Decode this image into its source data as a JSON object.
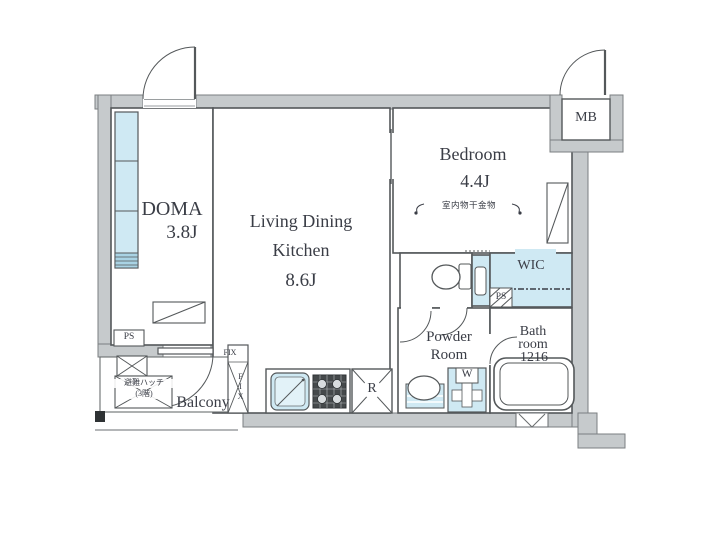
{
  "plan": {
    "rooms": {
      "doma": {
        "name": "DOMA",
        "size": "3.8J"
      },
      "ldk": {
        "name_line1": "Living Dining",
        "name_line2": "Kitchen",
        "size": "8.6J"
      },
      "bedroom": {
        "name": "Bedroom",
        "size": "4.4J",
        "note": "室内物干金物"
      },
      "wic": {
        "name": "WIC"
      },
      "powder": {
        "name_line1": "Powder",
        "name_line2": "Room"
      },
      "bath": {
        "name_line1": "Bath",
        "name_line2": "room",
        "size": "1216"
      },
      "balcony": {
        "name": "Balcony"
      },
      "mb": {
        "name": "MB"
      }
    },
    "labels": {
      "ps": "PS",
      "fix": "FIX",
      "hatch_line1": "避難ハッチ",
      "hatch_line2": "(3階)",
      "refrigerator": "R",
      "washer": "W"
    },
    "colors": {
      "wall": "#c6cacc",
      "fixture_blue": "#cfe9f3",
      "line": "#54585a",
      "text": "#3a3d46"
    }
  }
}
